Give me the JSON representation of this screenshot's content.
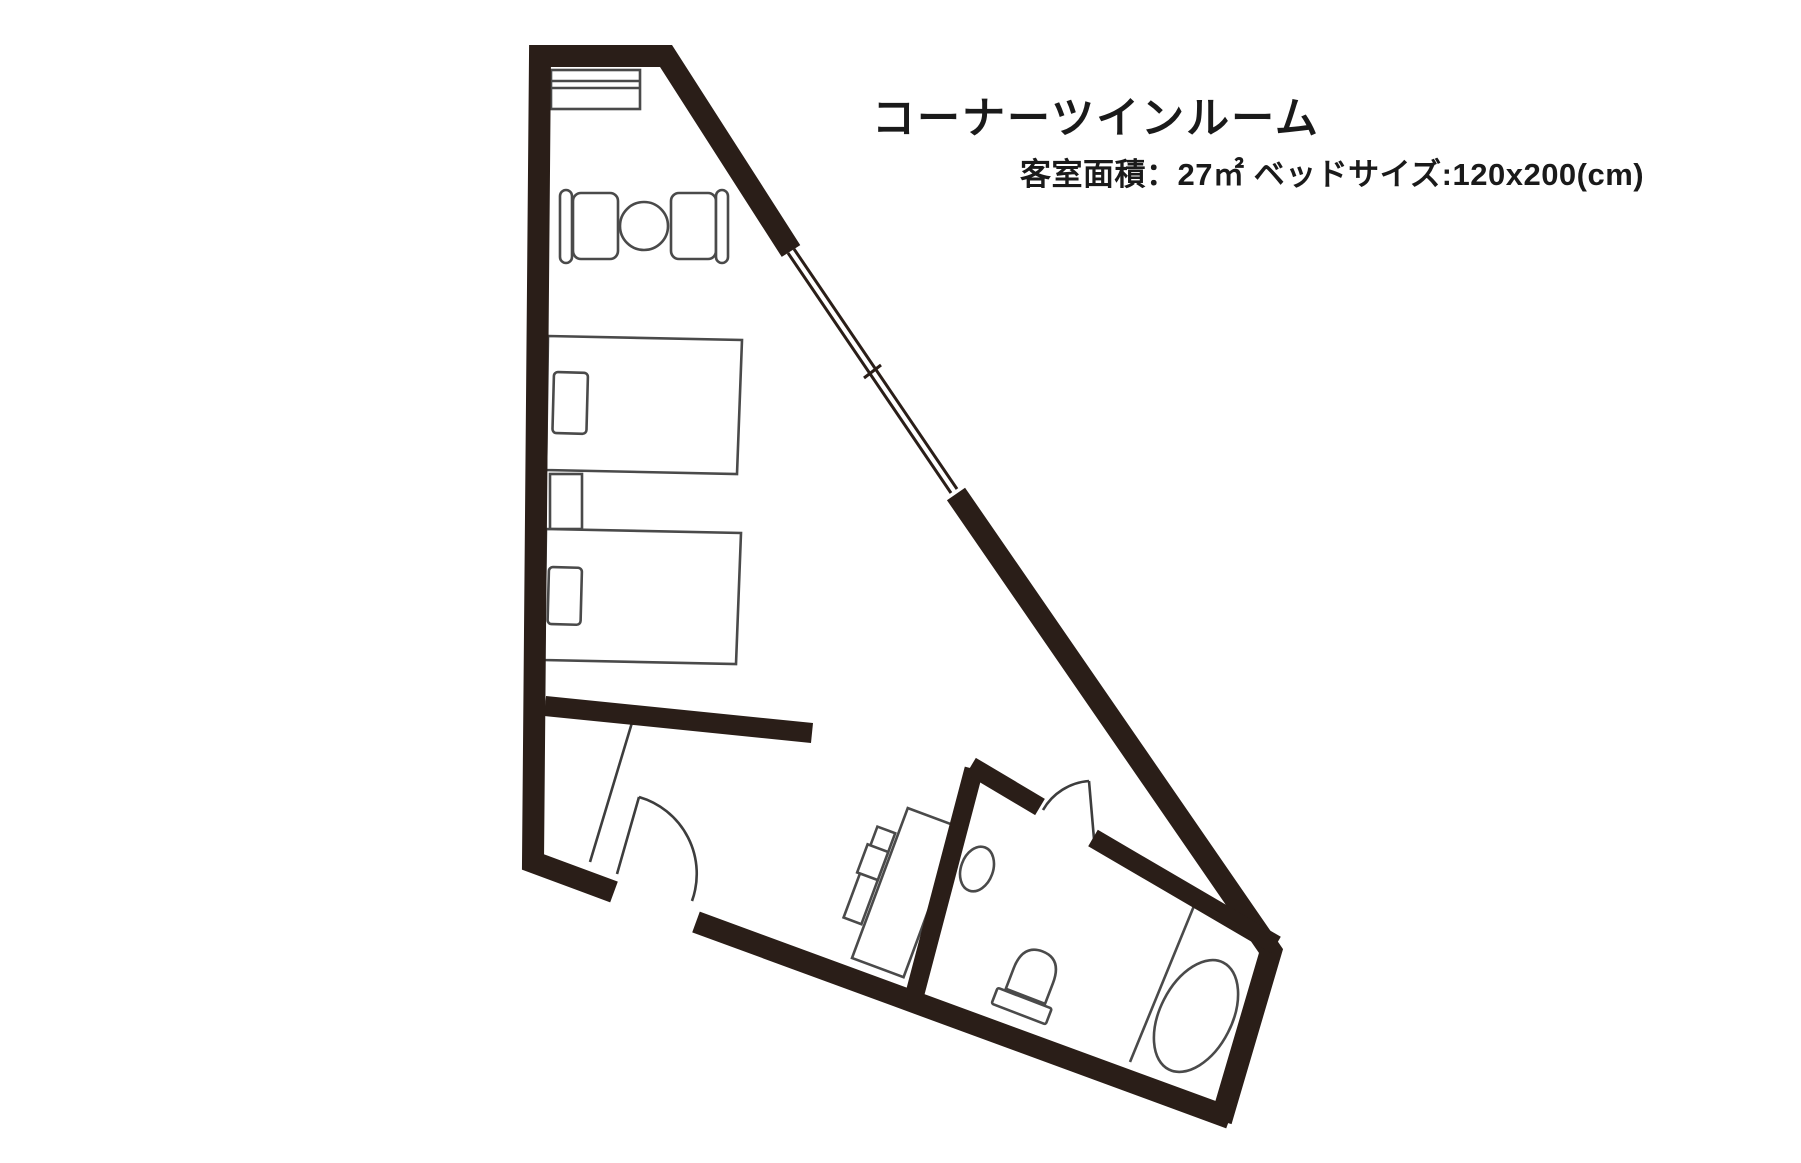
{
  "page": {
    "background": "#ffffff",
    "width": 1801,
    "height": 1163
  },
  "header": {
    "title": "コーナーツインルーム",
    "subtitle": "客室面積：27㎡  ベッドサイズ:120x200(cm)"
  },
  "floorplan": {
    "kind": "hotel-guest-room-floor-plan",
    "room_shape": "triangular-corner-room",
    "colors": {
      "wall": "#2a1e18",
      "window_line": "#2a1e18",
      "furniture_line": "#4a4a4a",
      "door_line": "#3d3d3d",
      "floor": "#ffffff"
    },
    "elements": [
      "outer-walls",
      "diagonal-window",
      "luggage-shelf",
      "cafe-table",
      "chair-left",
      "chair-right",
      "twin-bed-upper",
      "twin-bed-lower",
      "pillow-upper",
      "pillow-lower",
      "nightstand",
      "interior-wall",
      "entry-closet-partition",
      "entrance-door",
      "desk",
      "tv-board",
      "tv",
      "bathroom",
      "bathroom-door",
      "washbasin",
      "toilet",
      "bathtub-partition",
      "bathtub"
    ]
  }
}
